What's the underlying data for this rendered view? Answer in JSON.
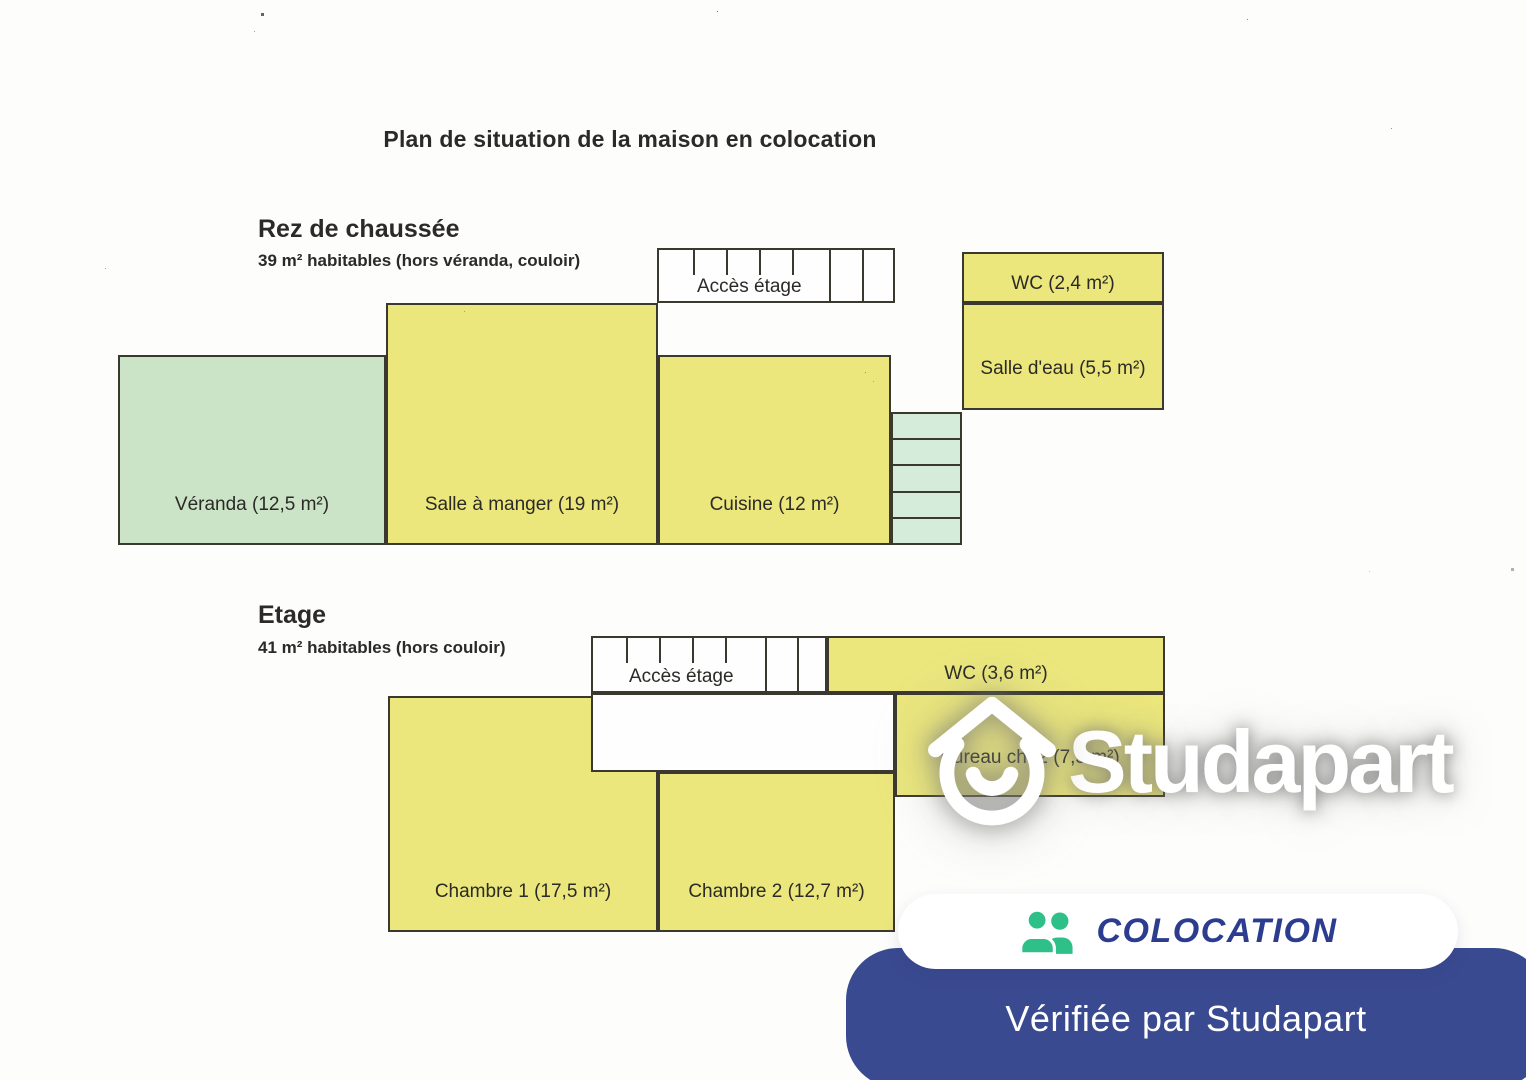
{
  "document": {
    "title": "Plan de situation de la maison en colocation"
  },
  "ground_floor": {
    "heading": "Rez de chaussée",
    "subtitle": "39 m² habitables (hors véranda, couloir)",
    "stairs_label": "Accès étage",
    "rooms": {
      "veranda": {
        "label": "Véranda (12,5 m²)"
      },
      "dining_room": {
        "label": "Salle à manger (19 m²)"
      },
      "kitchen": {
        "label": "Cuisine (12 m²)"
      },
      "wc": {
        "label": "WC (2,4 m²)"
      },
      "shower_room": {
        "label": "Salle d'eau (5,5 m²)"
      }
    }
  },
  "first_floor": {
    "heading": "Etage",
    "subtitle": "41 m² habitables (hors couloir)",
    "stairs_label": "Accès étage",
    "rooms": {
      "wc": {
        "label": "WC (3,6 m²)"
      },
      "office": {
        "label": "Bureau ch. 2 (7,5 m²)"
      },
      "bedroom_1": {
        "label": "Chambre 1 (17,5 m²)"
      },
      "bedroom_2": {
        "label": "Chambre 2 (12,7 m²)"
      }
    }
  },
  "overlay": {
    "watermark_brand": "Studapart",
    "badge_label": "COLOCATION",
    "banner_text": "Vérifiée par Studapart"
  },
  "colors": {
    "room_yellow": "#ebe77d",
    "veranda_green": "#cbe3c6",
    "stairs_green": "#d6ecdb",
    "plan_outline": "#3a382f",
    "text_dark": "#2b2a26",
    "badge_text_blue": "#2c3d8f",
    "banner_blue": "#3a4a91",
    "icon_green": "#2fc08a",
    "watermark_white": "#ffffff"
  }
}
